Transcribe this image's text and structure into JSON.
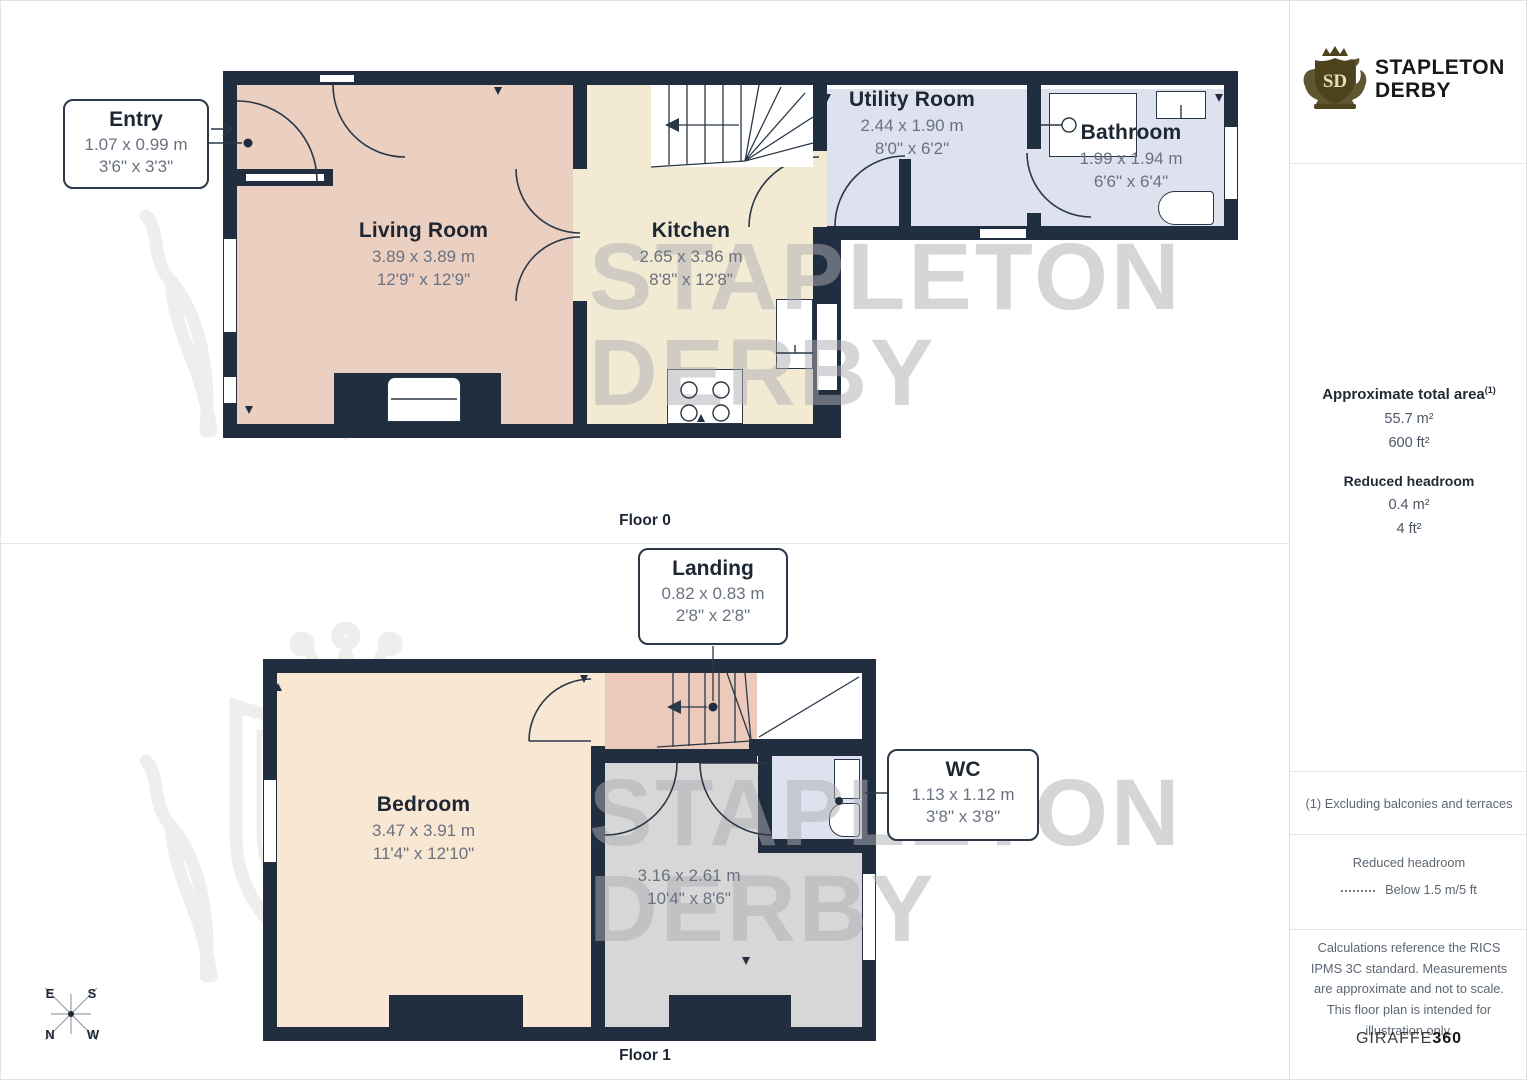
{
  "brand": {
    "monogram": "SD",
    "line1": "STAPLETON",
    "line2": "DERBY"
  },
  "floor0": {
    "label": "Floor 0",
    "entry": {
      "name": "Entry",
      "metric": "1.07 x 0.99 m",
      "imperial": "3'6\" x 3'3\""
    },
    "living": {
      "name": "Living Room",
      "metric": "3.89 x 3.89 m",
      "imperial": "12'9\" x 12'9\""
    },
    "kitchen": {
      "name": "Kitchen",
      "metric": "2.65 x 3.86 m",
      "imperial": "8'8\" x 12'8\""
    },
    "utility": {
      "name": "Utility Room",
      "metric": "2.44 x 1.90 m",
      "imperial": "8'0\" x 6'2\""
    },
    "bathroom": {
      "name": "Bathroom",
      "metric": "1.99 x 1.94 m",
      "imperial": "6'6\" x 6'4\""
    }
  },
  "floor1": {
    "label": "Floor 1",
    "landing": {
      "name": "Landing",
      "metric": "0.82 x 0.83 m",
      "imperial": "2'8\" x 2'8\""
    },
    "bedroom": {
      "name": "Bedroom",
      "metric": "3.47 x 3.91 m",
      "imperial": "11'4\" x 12'10\""
    },
    "room": {
      "metric": "3.16 x 2.61 m",
      "imperial": "10'4\" x 8'6\""
    },
    "wc": {
      "name": "WC",
      "metric": "1.13 x 1.12 m",
      "imperial": "3'8\" x 3'8\""
    }
  },
  "sidebar": {
    "total_area_label": "Approximate total area",
    "total_area_sup": "(1)",
    "total_area_m2": "55.7 m²",
    "total_area_ft2": "600 ft²",
    "reduced_headroom_label": "Reduced headroom",
    "reduced_headroom_m2": "0.4 m²",
    "reduced_headroom_ft2": "4 ft²",
    "footnote": "(1) Excluding balconies and terraces",
    "legend_title": "Reduced headroom",
    "legend_value": "Below 1.5 m/5 ft",
    "disclaimer": "Calculations reference the RICS IPMS 3C standard. Measurements are approximate and not to scale. This floor plan is intended for illustration only.",
    "credit_normal": "GIRAFFE",
    "credit_bold": "360"
  },
  "compass": {
    "top_left": "E",
    "top_right": "S",
    "bottom_left": "N",
    "bottom_right": "W"
  },
  "colors": {
    "wall": "#212e40",
    "living": "#ebcfc0",
    "kitchen": "#f2ead2",
    "wet_room": "#dde2ee",
    "bedroom": "#f8e7d2",
    "landing": "#eccabb",
    "gray_room": "#d7d7d7",
    "logo_bronze": "#4d431c",
    "label_dark": "#1d2633",
    "dim_gray": "#6a7280"
  }
}
